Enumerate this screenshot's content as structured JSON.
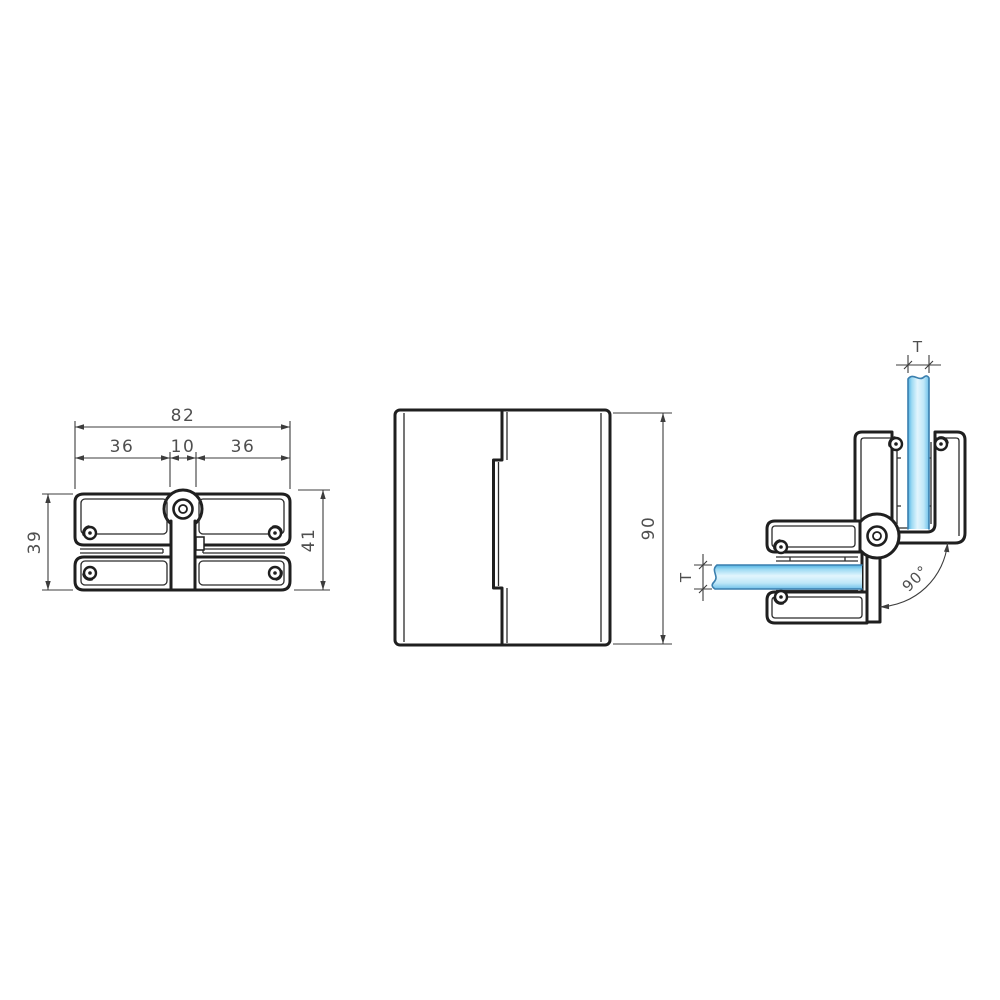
{
  "drawing": {
    "front_view": {
      "width_total": "82",
      "width_left": "36",
      "width_center": "10",
      "width_right": "36",
      "height_left": "39",
      "height_right": "41"
    },
    "side_view": {
      "height": "90"
    },
    "open_view": {
      "glass_thickness_vertical": "T",
      "glass_thickness_horizontal": "T",
      "opening_angle": "90°"
    },
    "colors": {
      "line": "#1f1f1f",
      "dimension_line": "#3d3d3d",
      "text": "#4f4f4f",
      "glass_edge": "#4fb1e3",
      "glass_light": "#e2f5fd",
      "glass_mid": "#8ecfee",
      "background": "#ffffff"
    }
  }
}
